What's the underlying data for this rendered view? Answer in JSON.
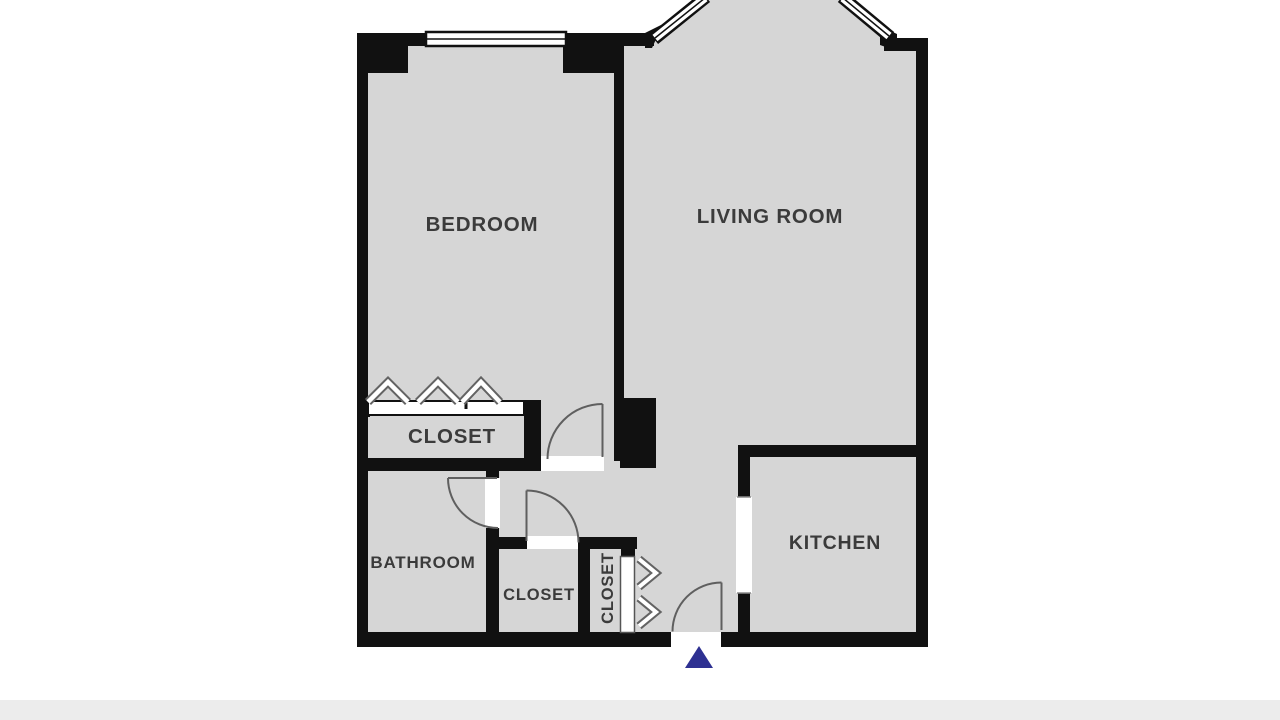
{
  "floorplan": {
    "rooms": [
      {
        "id": "bedroom",
        "label": "BEDROOM"
      },
      {
        "id": "living-room",
        "label": "LIVING ROOM"
      },
      {
        "id": "bedroom-closet",
        "label": "CLOSET"
      },
      {
        "id": "bathroom",
        "label": "BATHROOM"
      },
      {
        "id": "hallway-closet",
        "label": "CLOSET"
      },
      {
        "id": "entry-closet",
        "label": "CLOSET"
      },
      {
        "id": "kitchen",
        "label": "KITCHEN"
      }
    ],
    "symbols": {
      "windows": [
        "bedroom-window",
        "bay-window-left",
        "bay-window-right"
      ],
      "doors": [
        "bedroom-door",
        "bathroom-door",
        "hallway-closet-door",
        "entry-door"
      ],
      "sliding_doors": [
        "bedroom-closet-sliding-door",
        "entry-closet-sliding-door"
      ],
      "chevron_groups": [
        "bedroom-closet-chevrons",
        "entry-closet-chevrons"
      ],
      "entry_marker": "entrance-arrow-triangle"
    },
    "colors": {
      "wall": "#111111",
      "floor": "#d6d6d6",
      "label": "#3b3b3b",
      "door_arc": "#5f5f5f",
      "entry_arrow": "#2e3192",
      "footer_bar": "#ececec"
    }
  }
}
